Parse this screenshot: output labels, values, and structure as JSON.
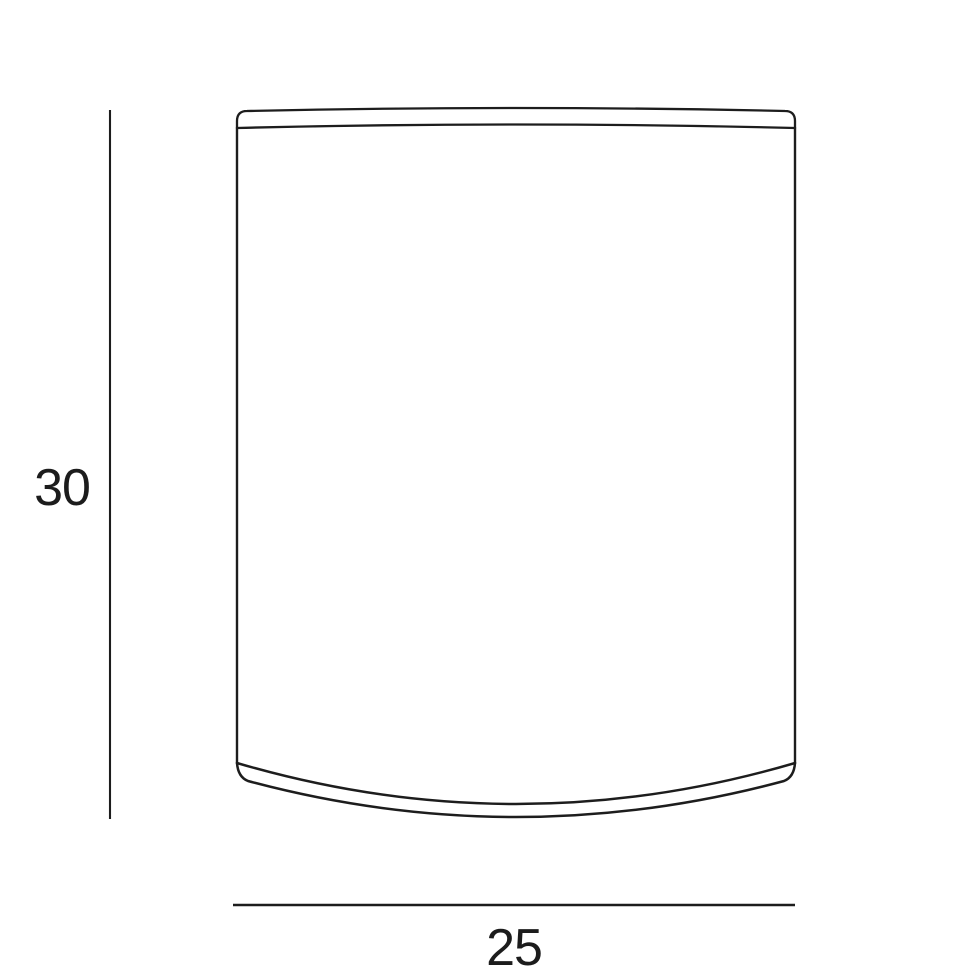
{
  "diagram": {
    "height_dimension": "30",
    "width_dimension": "25"
  },
  "colors": {
    "line": "#1d1d1d",
    "text": "#1c1c1c",
    "background": "#ffffff"
  }
}
